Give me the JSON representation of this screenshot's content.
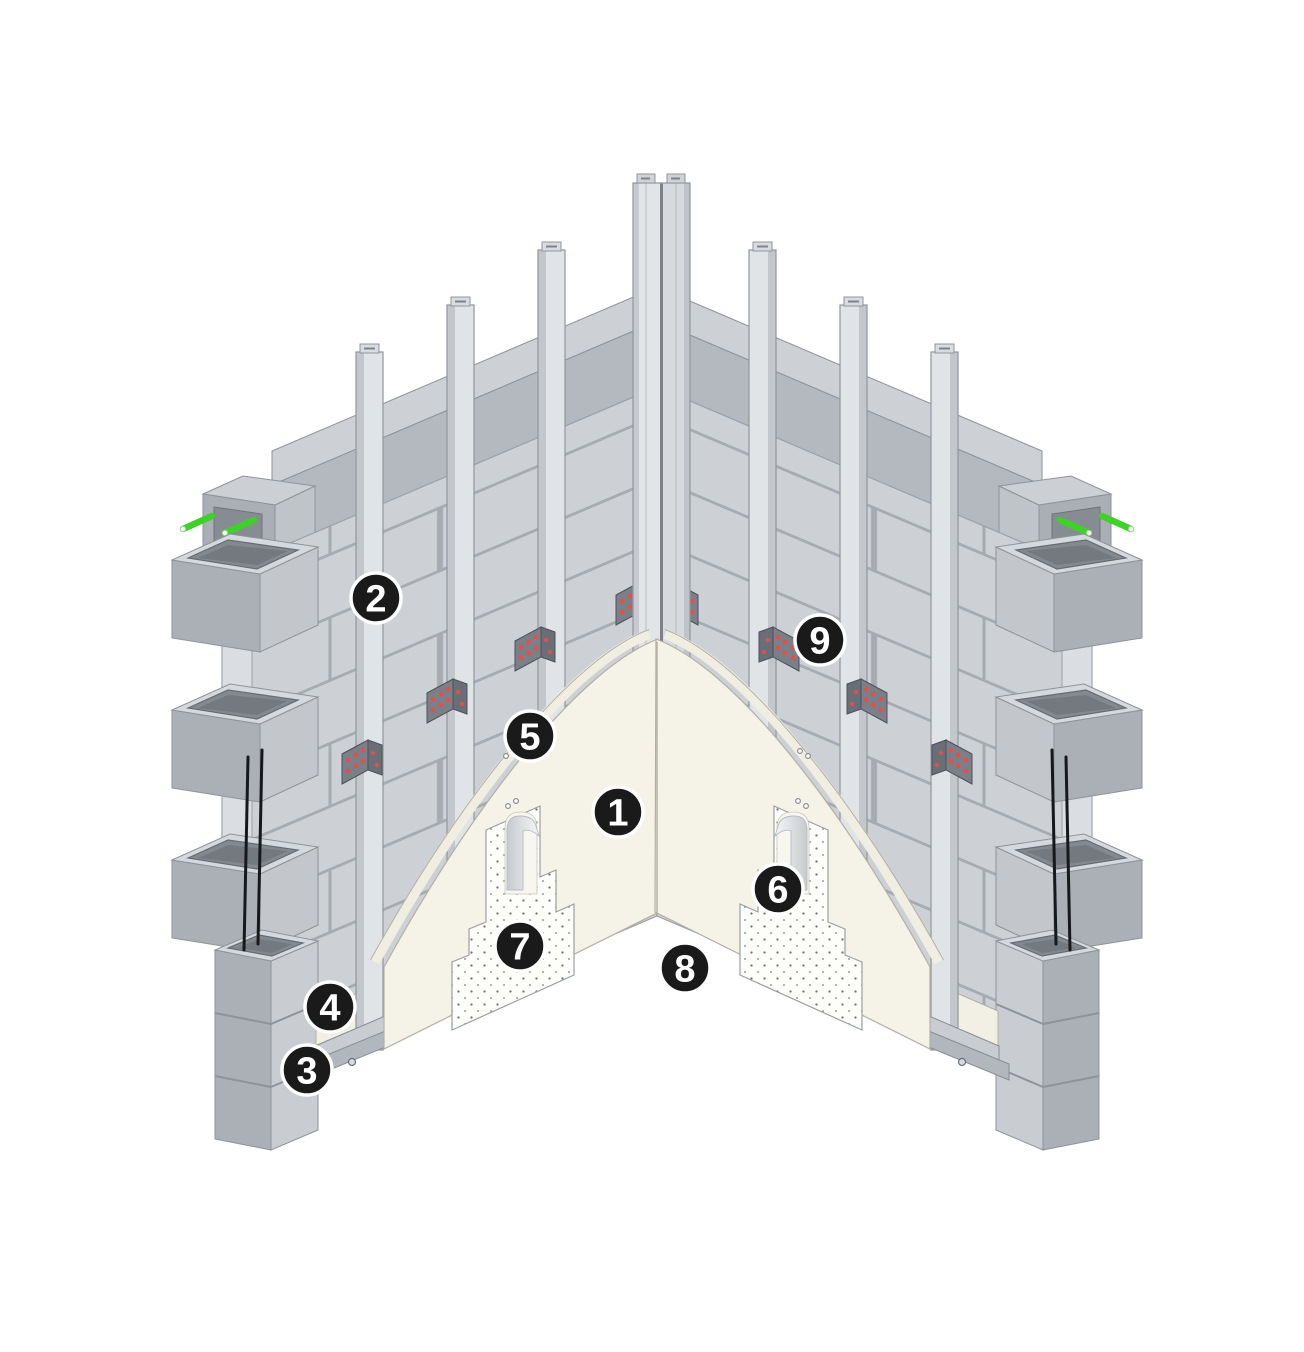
{
  "diagram": {
    "kind": "construction-detail-isometric",
    "subject": "masonry-wall-inside-corner-assembly",
    "callouts": [
      {
        "number": "1",
        "x": 618,
        "y": 812
      },
      {
        "number": "2",
        "x": 376,
        "y": 598
      },
      {
        "number": "3",
        "x": 307,
        "y": 1070
      },
      {
        "number": "4",
        "x": 330,
        "y": 1007
      },
      {
        "number": "5",
        "x": 530,
        "y": 736
      },
      {
        "number": "6",
        "x": 778,
        "y": 889
      },
      {
        "number": "7",
        "x": 520,
        "y": 946
      },
      {
        "number": "8",
        "x": 685,
        "y": 968
      },
      {
        "number": "9",
        "x": 820,
        "y": 640
      }
    ],
    "callout_style": {
      "radius": 25,
      "fill": "#1a1a1a",
      "ring": "#ffffff",
      "text": "#ffffff"
    },
    "colors": {
      "background": "#ffffff",
      "block_face": "#cdd1d5",
      "mortar_joint": "#a6abb1",
      "bond_beam_face": "#b4b9bf",
      "bond_beam_top": "#cdd1d6",
      "stud_face": "#e1e4e7",
      "stud_side": "#c3c7cc",
      "bracket": "#7b8088",
      "bracket_screw_red": "#e0504d",
      "dowel_green": "#3fd02c",
      "rebar_black": "#17181a",
      "sheathing_cream": "#f5f3e7",
      "insulation_white": "#fdfdfa",
      "insulation_dot": "#6f7478",
      "core_hole": "#84898f"
    }
  }
}
